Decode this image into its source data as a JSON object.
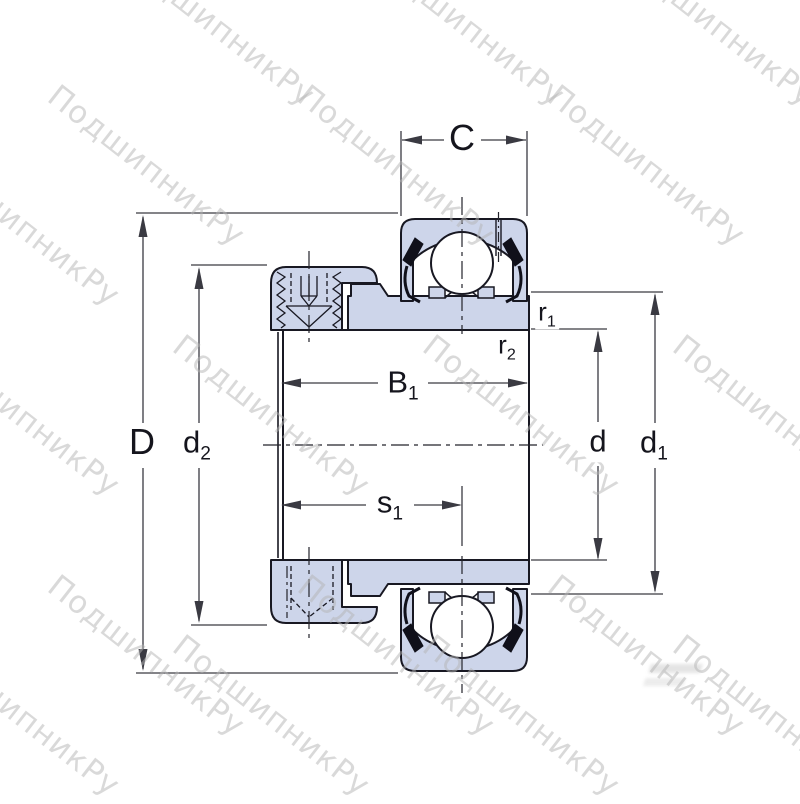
{
  "page": {
    "background": "#ffffff",
    "description": "Technical section drawing of an insert ball bearing with eccentric locking collar and dimension callouts"
  },
  "watermark": {
    "text": "ПодшипникРу",
    "color": "#b5b5b5",
    "opacity": 0.5,
    "angle_deg": 38
  },
  "drawing": {
    "fill_color": "#cdd5ea",
    "outline_color": "#181822",
    "dimension_line_color": "#3a3a42",
    "centerline_color": "#23232b",
    "ball_fill": "#ffffff",
    "seal_color": "#10101a"
  },
  "dimension_labels": {
    "C": {
      "main": "C",
      "sub": ""
    },
    "D": {
      "main": "D",
      "sub": ""
    },
    "d2": {
      "main": "d",
      "sub": "2"
    },
    "B1": {
      "main": "B",
      "sub": "1"
    },
    "s1": {
      "main": "s",
      "sub": "1"
    },
    "d": {
      "main": "d",
      "sub": ""
    },
    "d1": {
      "main": "d",
      "sub": "1"
    },
    "r1": {
      "main": "r",
      "sub": "1"
    },
    "r2": {
      "main": "r",
      "sub": "2"
    }
  }
}
